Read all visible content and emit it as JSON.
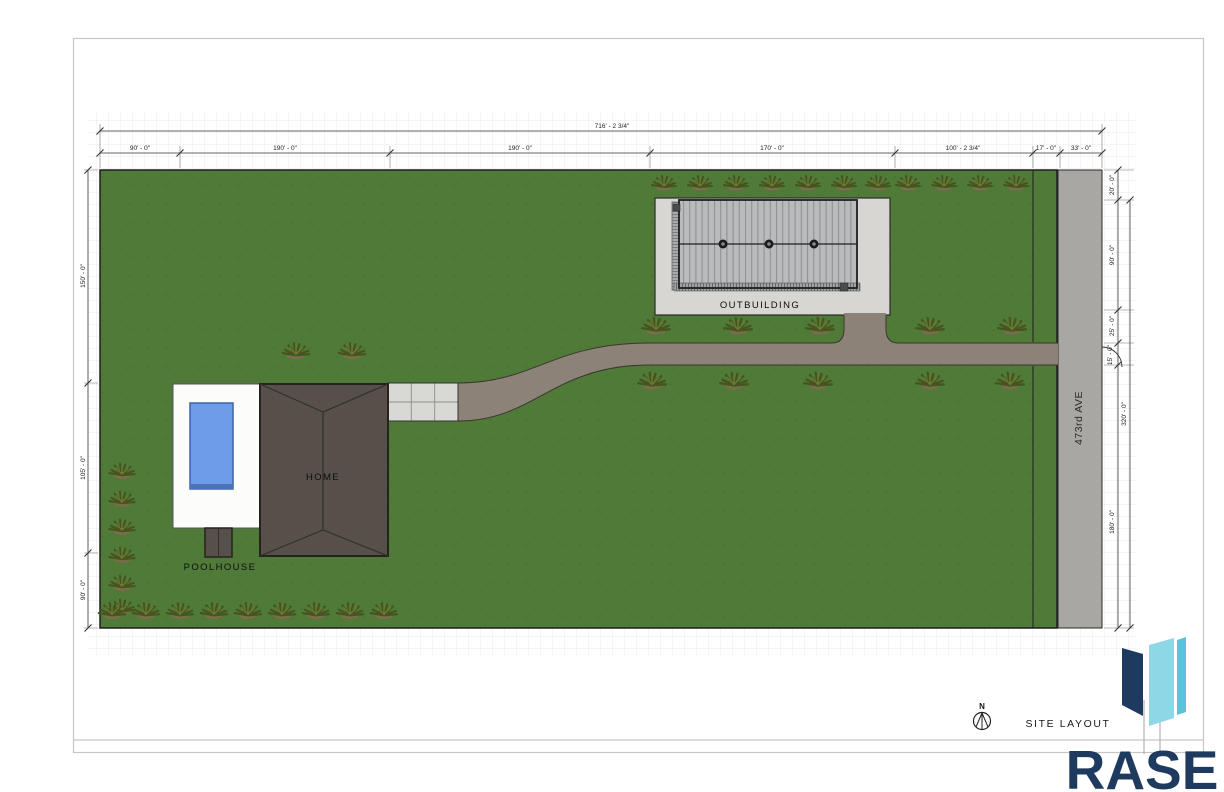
{
  "sheet": {
    "view_label": "SITE LAYOUT",
    "north_label": "N"
  },
  "logo": {
    "text": "RASE"
  },
  "labels": {
    "home": "HOME",
    "poolhouse": "POOLHOUSE",
    "outbuilding": "OUTBUILDING",
    "road": "473rd AVE"
  },
  "dimensions": {
    "top_overall": "716' - 2 3/4\"",
    "top_segments": [
      "90' - 0\"",
      "190' - 0\"",
      "190' - 0\"",
      "170' - 0\"",
      "100' - 2 3/4\"",
      "17' - 0\"",
      "33' - 0\""
    ],
    "left_segments": [
      "150' - 0\"",
      "105' - 0\"",
      "90' - 0\""
    ],
    "right_segments": [
      "20' - 0\"",
      "90' - 0\"",
      "25' - 0\"",
      "15' - 0\"",
      "180' - 0\""
    ],
    "right_overall": "320' - 0\""
  },
  "colors": {
    "grass": "#4f7a38",
    "road": "#a9a7a3",
    "driveway": "#8c8278",
    "pad": "#d7d6d3",
    "roof_metal": "#b9bbbd",
    "roof_home": "#57504a",
    "pool": "#6f9ce8",
    "deck": "#fcfcfb",
    "logo_navy": "#1e3a5f",
    "logo_cyan": "#8ed7e6"
  }
}
